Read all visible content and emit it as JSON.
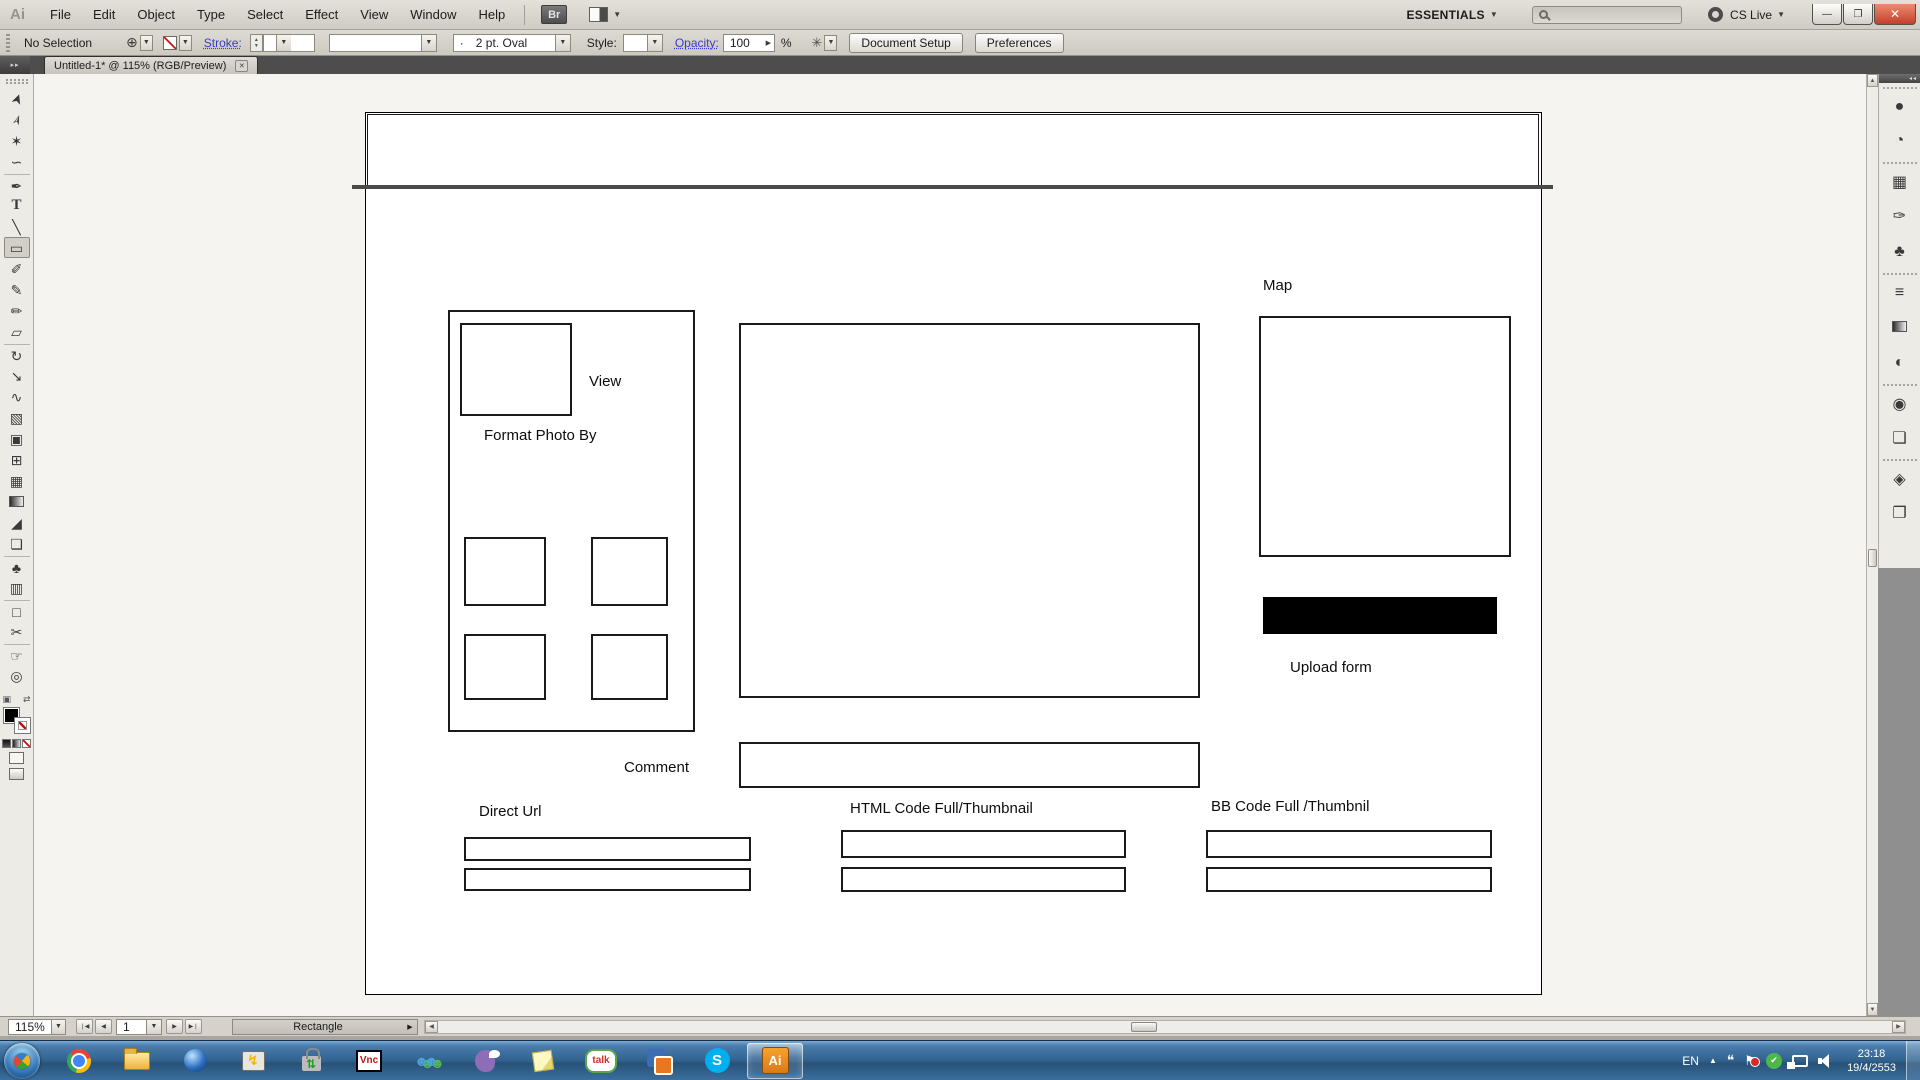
{
  "menu_bar": {
    "app_icon_label": "Ai",
    "menus": [
      "File",
      "Edit",
      "Object",
      "Type",
      "Select",
      "Effect",
      "View",
      "Window",
      "Help"
    ],
    "bridge_button_label": "Br",
    "workspace_label": "ESSENTIALS",
    "cs_live_label": "CS Live",
    "search_placeholder": "",
    "minimize_glyph": "—",
    "restore_glyph": "❐",
    "close_glyph": "✕"
  },
  "control_bar": {
    "selection_status": "No Selection",
    "fill_target_glyph": "⊕",
    "stroke_label": "Stroke:",
    "brush_preview_glyph": "·",
    "brush_value": "2 pt. Oval",
    "style_label": "Style:",
    "opacity_label": "Opacity:",
    "opacity_value": "100",
    "percent_label": "%",
    "select_similar_glyph": "✳",
    "document_setup_label": "Document Setup",
    "preferences_label": "Preferences"
  },
  "tab_bar": {
    "document_title": "Untitled-1* @ 115% (RGB/Preview)",
    "close_glyph": "✕",
    "expand_tools_glyph": "▸▸",
    "expand_dock_glyph": "◂◂"
  },
  "toolbar": {
    "tools": [
      {
        "name": "selection-tool",
        "glyph": "➤",
        "cls": "rot-up"
      },
      {
        "name": "direct-selection-tool",
        "glyph": "➢",
        "cls": "rot-up"
      },
      {
        "name": "magic-wand-tool",
        "glyph": "✶"
      },
      {
        "name": "lasso-tool",
        "glyph": "∽"
      },
      {
        "name": "pen-tool",
        "glyph": "✒",
        "cls": "group-start"
      },
      {
        "name": "type-tool",
        "glyph": "T",
        "cls": "serif"
      },
      {
        "name": "line-segment-tool",
        "glyph": "╲"
      },
      {
        "name": "rectangle-tool",
        "glyph": "▭",
        "selected": true
      },
      {
        "name": "paintbrush-tool",
        "glyph": "✐"
      },
      {
        "name": "pencil-tool",
        "glyph": "✎"
      },
      {
        "name": "blob-brush-tool",
        "glyph": "✏"
      },
      {
        "name": "eraser-tool",
        "glyph": "▱"
      },
      {
        "name": "rotate-tool",
        "glyph": "↻",
        "cls": "group-start"
      },
      {
        "name": "scale-tool",
        "glyph": "↘"
      },
      {
        "name": "width-tool",
        "glyph": "∿"
      },
      {
        "name": "free-transform-tool",
        "glyph": "▧"
      },
      {
        "name": "shape-builder-tool",
        "glyph": "▣"
      },
      {
        "name": "perspective-grid-tool",
        "glyph": "⊞"
      },
      {
        "name": "mesh-tool",
        "glyph": "▦"
      },
      {
        "name": "gradient-tool",
        "glyph": "",
        "cls": "ic-grad"
      },
      {
        "name": "eyedropper-tool",
        "glyph": "◢"
      },
      {
        "name": "blend-tool",
        "glyph": "❏"
      },
      {
        "name": "symbol-sprayer-tool",
        "glyph": "♣",
        "cls": "group-start"
      },
      {
        "name": "column-graph-tool",
        "glyph": "▥"
      },
      {
        "name": "artboard-tool",
        "glyph": "□",
        "cls": "group-start"
      },
      {
        "name": "slice-tool",
        "glyph": "✂"
      },
      {
        "name": "hand-tool",
        "glyph": "☞",
        "cls": "group-start"
      },
      {
        "name": "zoom-tool",
        "glyph": "◎"
      }
    ],
    "default_swatches_glyph": "▣",
    "swap_fill_stroke_glyph": "⇄"
  },
  "right_dock": {
    "panels": [
      {
        "name": "panel-color",
        "glyph": "●",
        "cls": "group-start"
      },
      {
        "name": "panel-color-guide",
        "glyph": "◔"
      },
      {
        "name": "panel-swatches",
        "glyph": "▦",
        "cls": "group-start"
      },
      {
        "name": "panel-brushes",
        "glyph": "✑"
      },
      {
        "name": "panel-symbols",
        "glyph": "♣"
      },
      {
        "name": "panel-stroke",
        "glyph": "≡",
        "cls": "group-start"
      },
      {
        "name": "panel-gradient",
        "glyph": "",
        "cls": "ic-grad"
      },
      {
        "name": "panel-transparency",
        "glyph": "◐"
      },
      {
        "name": "panel-appearance",
        "glyph": "◉",
        "cls": "group-start"
      },
      {
        "name": "panel-graphic-styles",
        "glyph": "❏"
      },
      {
        "name": "panel-layers",
        "glyph": "◈",
        "cls": "group-start"
      },
      {
        "name": "panel-artboards",
        "glyph": "❐"
      }
    ]
  },
  "artboard": {
    "labels": {
      "view": "View",
      "format_photo_by": "Format Photo By",
      "map": "Map",
      "upload_form": "Upload form",
      "comment": "Comment",
      "direct_url": "Direct Url",
      "html_code": "HTML Code Full/Thumbnail",
      "bb_code": "BB Code Full /Thumbnil"
    }
  },
  "status_bar": {
    "zoom_level": "115%",
    "artboard_number": "1",
    "current_tool": "Rectangle",
    "nav_first_glyph": "❘◀",
    "nav_prev_glyph": "◀",
    "nav_next_glyph": "▶",
    "nav_last_glyph": "▶❘",
    "dropdown_glyph": "▼",
    "expand_glyph": "▶"
  },
  "taskbar": {
    "items": [
      {
        "name": "taskbar-chrome",
        "glyph": "",
        "cls": "ic-chrome"
      },
      {
        "name": "taskbar-explorer",
        "glyph": "",
        "cls": "ic-explorer"
      },
      {
        "name": "taskbar-globe-browser",
        "glyph": "",
        "cls": "ic-globe"
      },
      {
        "name": "taskbar-remote-desktop",
        "glyph": "↯",
        "cls": "ic-remote"
      },
      {
        "name": "taskbar-secure-transfer",
        "glyph": "⇅",
        "cls": "ic-lock"
      },
      {
        "name": "taskbar-vnc",
        "glyph": "Vnc",
        "cls": "ic-vnc"
      },
      {
        "name": "taskbar-messenger",
        "glyph": "☻☻",
        "cls": "ic-msn"
      },
      {
        "name": "taskbar-pidgin",
        "glyph": "",
        "cls": "ic-pidgin"
      },
      {
        "name": "taskbar-sticky-notes",
        "glyph": "",
        "cls": "ic-notes"
      },
      {
        "name": "taskbar-google-talk",
        "glyph": "talk",
        "cls": "ic-gtalk"
      },
      {
        "name": "taskbar-vmware",
        "glyph": "",
        "cls": "ic-vmware"
      },
      {
        "name": "taskbar-skype",
        "glyph": "S",
        "cls": "ic-skype"
      },
      {
        "name": "taskbar-illustrator",
        "glyph": "Ai",
        "cls": "ic-ai",
        "active": true
      }
    ],
    "tray_items": [
      {
        "name": "tray-language-indicator",
        "glyph": "EN",
        "cls": "ic-lang"
      },
      {
        "name": "tray-show-hidden-icons",
        "glyph": "▲",
        "cls": "ic-up"
      },
      {
        "name": "tray-messenger-icon",
        "glyph": "❝",
        "cls": "ic-bubble"
      },
      {
        "name": "tray-action-center-icon",
        "glyph": "⚑",
        "cls": "ic-flagx"
      },
      {
        "name": "tray-status-ok-icon",
        "glyph": "✔",
        "cls": "ic-check"
      },
      {
        "name": "tray-network-icon",
        "glyph": "",
        "cls": "ic-net"
      },
      {
        "name": "tray-volume-icon",
        "glyph": "",
        "cls": "ic-vol"
      }
    ],
    "tray": {
      "time": "23:18",
      "date": "19/4/2553"
    }
  }
}
